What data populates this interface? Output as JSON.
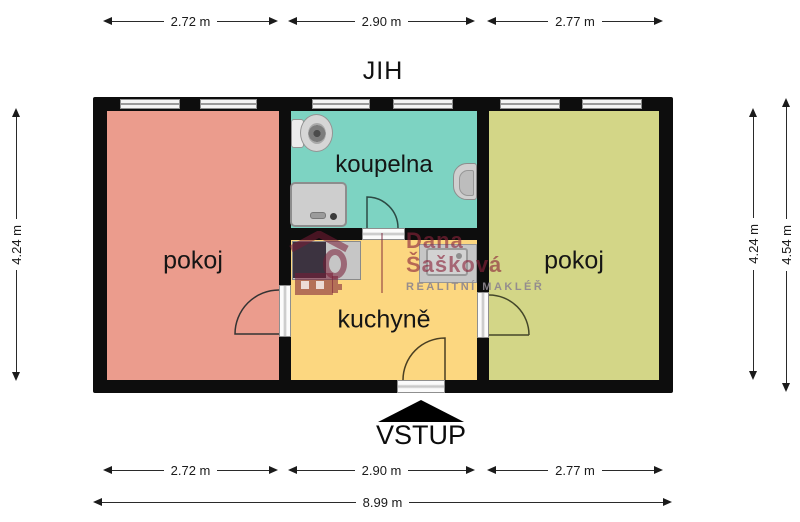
{
  "title": {
    "orientation_label": "JIH",
    "entrance_label": "VSTUP"
  },
  "rooms": [
    {
      "id": "pokoj-left",
      "label": "pokoj",
      "color": "#eb9c8d"
    },
    {
      "id": "koupelna",
      "label": "koupelna",
      "color": "#7dd3c2"
    },
    {
      "id": "kuchyne",
      "label": "kuchyně",
      "color": "#fcd780"
    },
    {
      "id": "pokoj-right",
      "label": "pokoj",
      "color": "#d3d687"
    }
  ],
  "dimensions": {
    "top": [
      "2.72 m",
      "2.90 m",
      "2.77 m"
    ],
    "bottom": [
      "2.72 m",
      "2.90 m",
      "2.77 m"
    ],
    "total_width": "8.99 m",
    "left_height": "4.24 m",
    "right_inner_height": "4.24 m",
    "right_outer_height": "4.54 m"
  },
  "watermark": {
    "name": "Dana",
    "surname": "Šašková",
    "tagline": "REALITNÍ MAKLÉŘ",
    "accent_color": "#8a243a",
    "tagline_color": "#8e878e"
  },
  "palette": {
    "wall_color": "#0d0d0d",
    "background": "#ffffff",
    "fixture_gray": "#c6c6c6"
  },
  "icons": [
    "toilet-icon",
    "shower-icon",
    "washbasin-icon",
    "stove-icon",
    "kitchen-sink-icon",
    "entrance-arrow-icon",
    "realtor-logo-icon",
    "door-swing-icon",
    "window-icon"
  ]
}
